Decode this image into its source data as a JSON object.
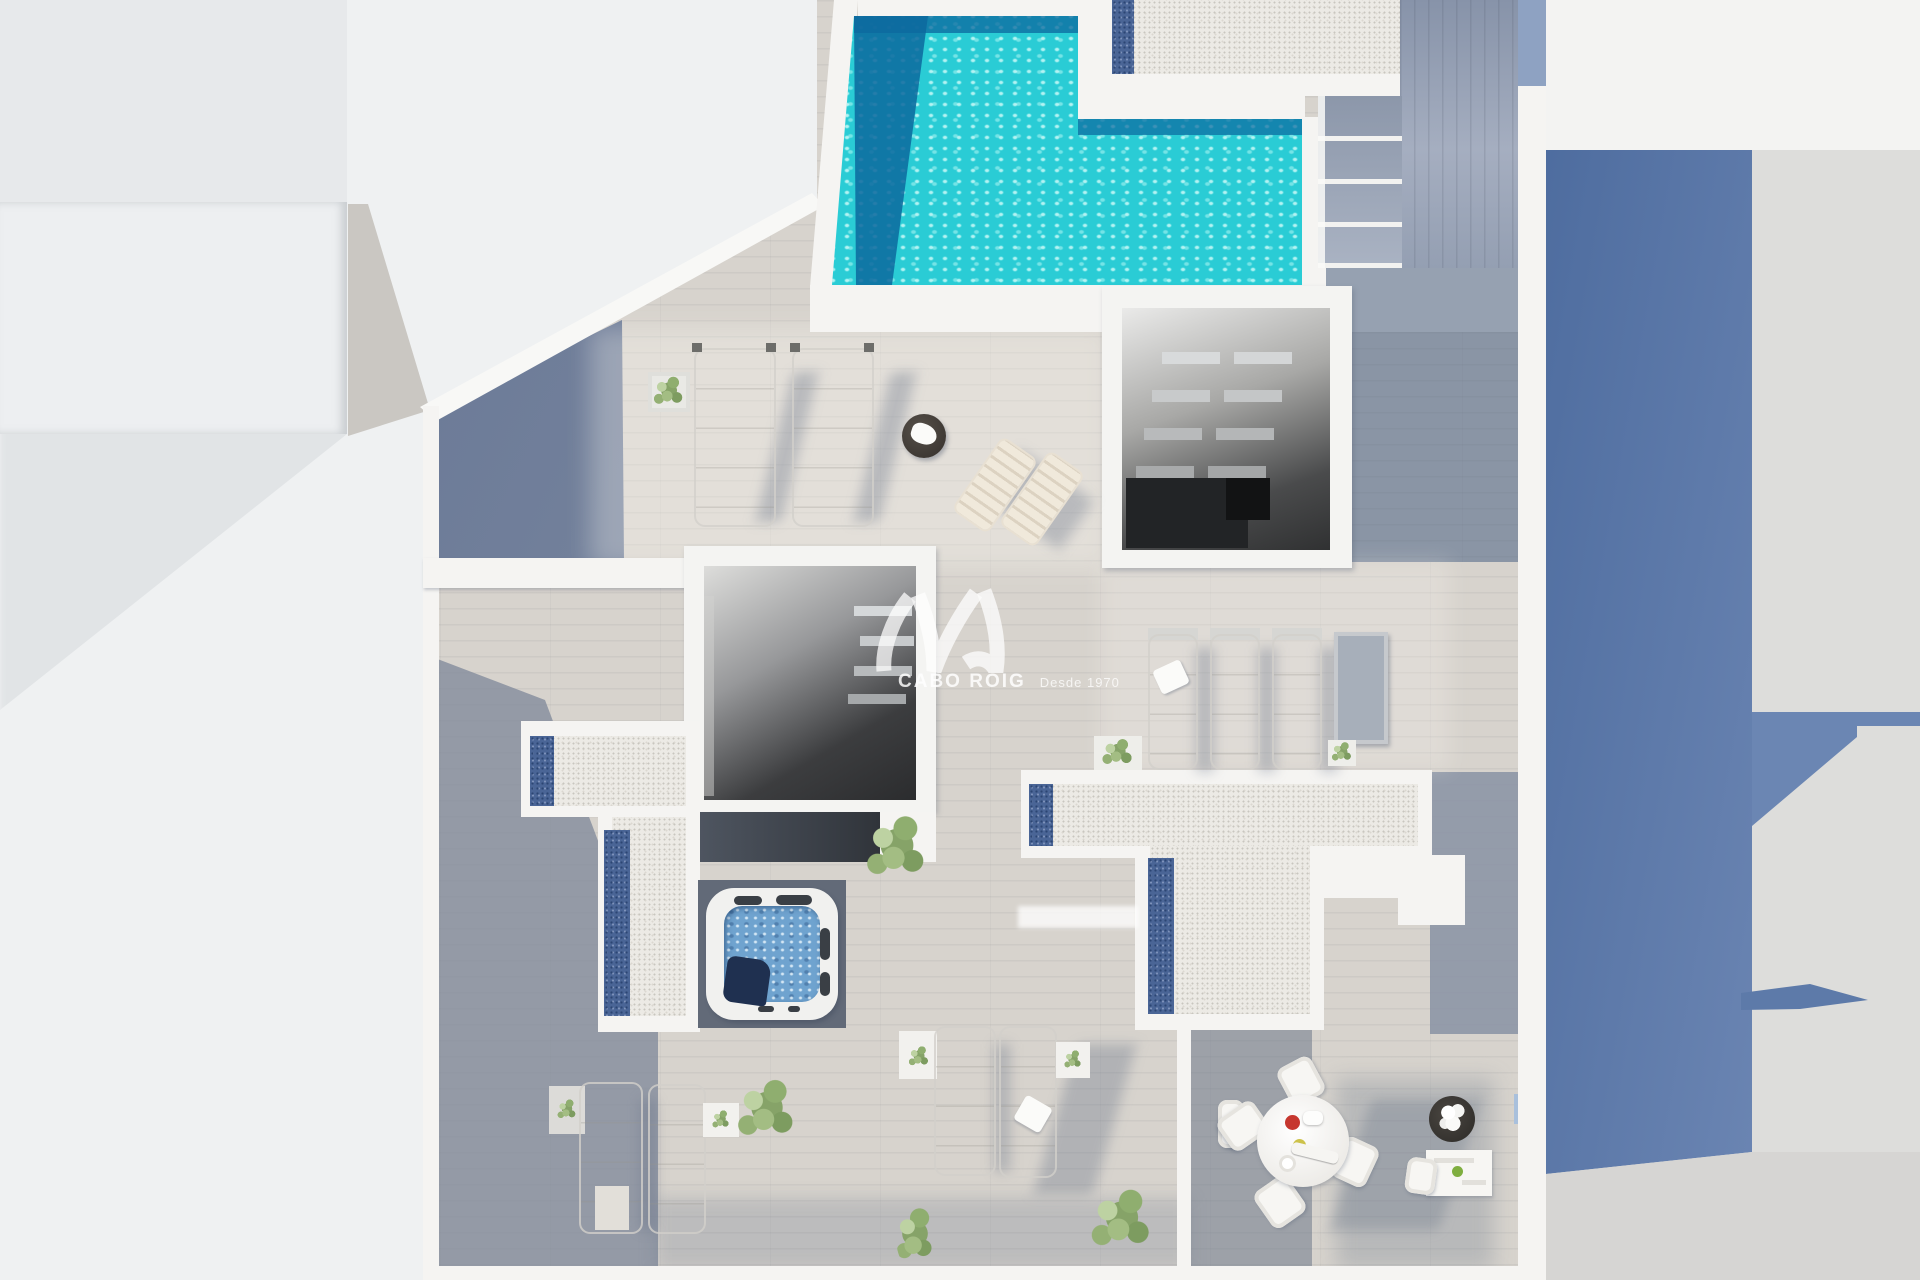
{
  "watermark": {
    "brand": "CABO ROIG",
    "tagline": "Desde 1970"
  },
  "scene": {
    "type": "aerial-3d-render",
    "description": "Top-down 3D architectural render of a rooftop solarium",
    "features": {
      "pool": "L-shaped swimming pool",
      "gravel_terrace_north": "white pebble terrace beside pool",
      "pool_stairs": "exterior staircase beside pool",
      "north_stairwell": "open stairwell skylight with floating treads",
      "central_stairwell": "open stairwell skylight with floating treads",
      "west_pebble_terrace": "pebble terrace with blue gravel strips",
      "east_pebble_terrace": "T-shaped pebble terrace with blue gravel strips",
      "jacuzzi": "square hot tub",
      "sunbeds": "two padded sunbeds with side table",
      "wooden_loungers": "two folding deck loungers",
      "lounger_row_east": "row of sun loungers with planters",
      "loungers_south_west": "two loungers with side tables",
      "loungers_south_center": "two loungers with side tables",
      "dining_set": "round table with four chairs, flower pot and serving table",
      "plants": "potted shrubs and bushes",
      "neighbor_left": "neighbouring roofs",
      "neighbor_right": "neighbouring building wall with cast shadows"
    },
    "colors": {
      "background": "#eff1f2",
      "deck_sunlit": "#d7d3cd",
      "deck_shaded": "#8e99ad",
      "pool_water": "#2accd5",
      "pool_shadow": "#0f6f9e",
      "pebble": "#eceae5",
      "blue_gravel": "#4a6596",
      "jacuzzi_water": "#6fa3cf",
      "building_shadow_blue": "#5d7aa9",
      "walls": "#f5f4f2"
    }
  }
}
